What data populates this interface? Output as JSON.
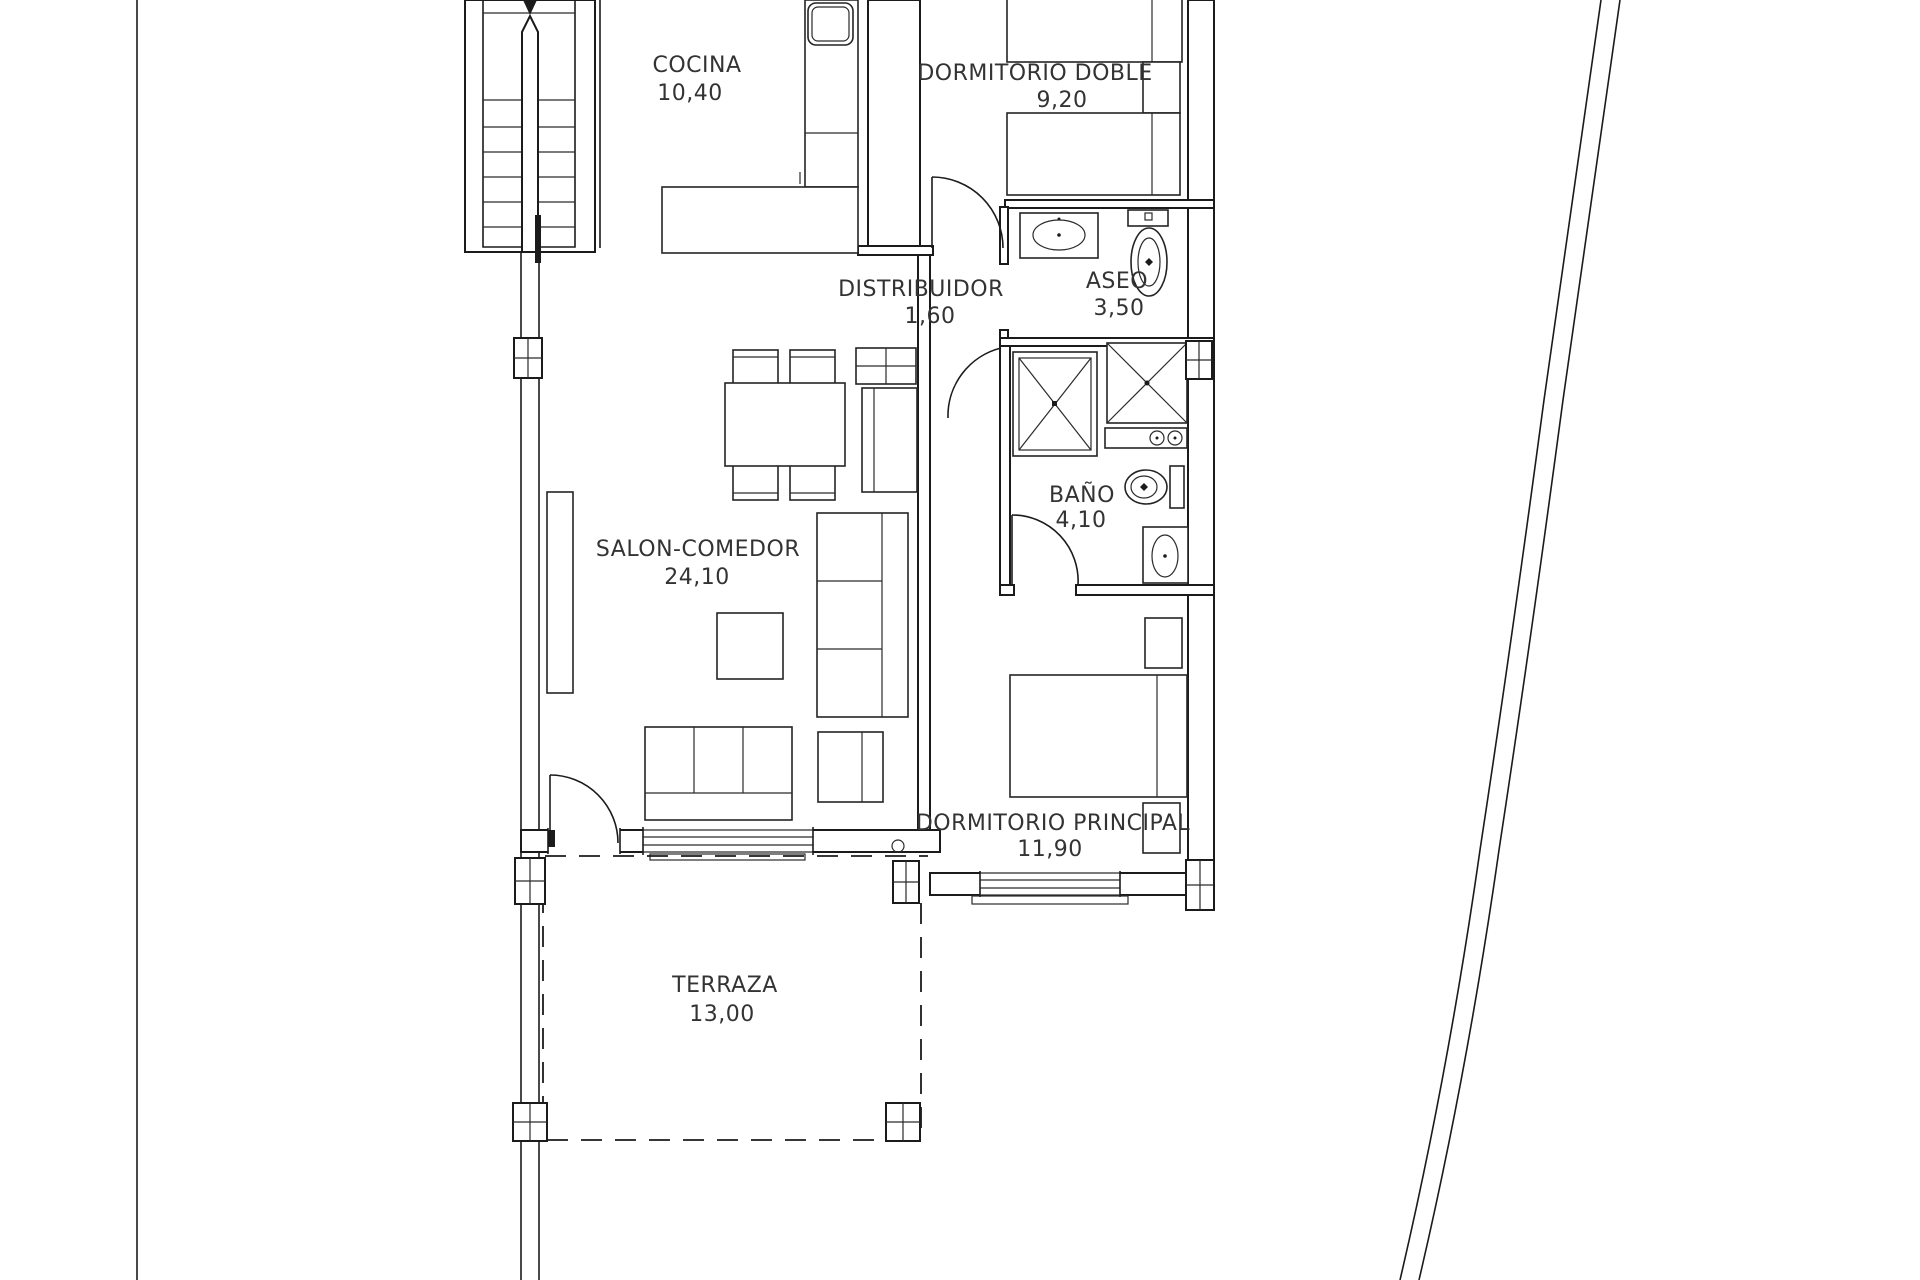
{
  "rooms": [
    {
      "id": "cocina",
      "label": "COCINA",
      "area": "10,40"
    },
    {
      "id": "dormitorio-doble",
      "label": "DORMITORIO DOBLE",
      "area": "9,20"
    },
    {
      "id": "distribuidor",
      "label": "DISTRIBUIDOR",
      "area": "1,60"
    },
    {
      "id": "aseo",
      "label": "ASEO",
      "area": "3,50"
    },
    {
      "id": "bano",
      "label": "BAÑO",
      "area": "4,10"
    },
    {
      "id": "salon-comedor",
      "label": "SALON-COMEDOR",
      "area": "24,10"
    },
    {
      "id": "dormitorio-principal",
      "label": "DORMITORIO PRINCIPAL",
      "area": "11,90"
    },
    {
      "id": "terraza",
      "label": "TERRAZA",
      "area": "13,00"
    }
  ],
  "colors": {
    "line": "#1b1b1b",
    "text": "#333333",
    "background": "#ffffff"
  }
}
